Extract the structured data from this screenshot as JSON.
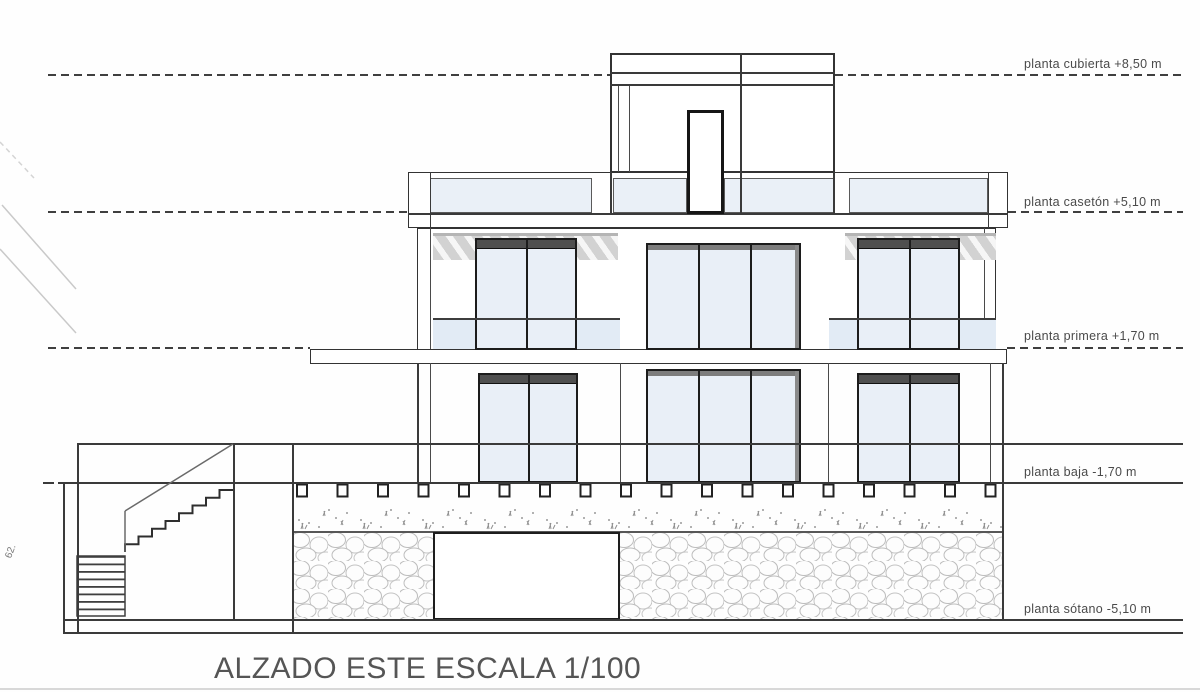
{
  "drawing": {
    "title": "ALZADO ESTE ESCALA 1/100",
    "side_mark": "62.",
    "levels": [
      {
        "name": "planta cubierta",
        "elevation": "+8,50 m",
        "label": "planta cubierta +8,50 m"
      },
      {
        "name": "planta casetón",
        "elevation": "+5,10 m",
        "label": "planta casetón +5,10 m"
      },
      {
        "name": "planta primera",
        "elevation": "+1,70 m",
        "label": "planta primera +1,70 m"
      },
      {
        "name": "planta baja",
        "elevation": "-1,70 m",
        "label": "planta baja -1,70 m"
      },
      {
        "name": "planta sótano",
        "elevation": "-5,10 m",
        "label": "planta sótano -5,10 m"
      }
    ]
  },
  "colors": {
    "line": "#3a3a3a",
    "glass": "#eaf0f7",
    "balustrade_glass": "#e2ebf5",
    "label_text": "#4a4a4a"
  }
}
